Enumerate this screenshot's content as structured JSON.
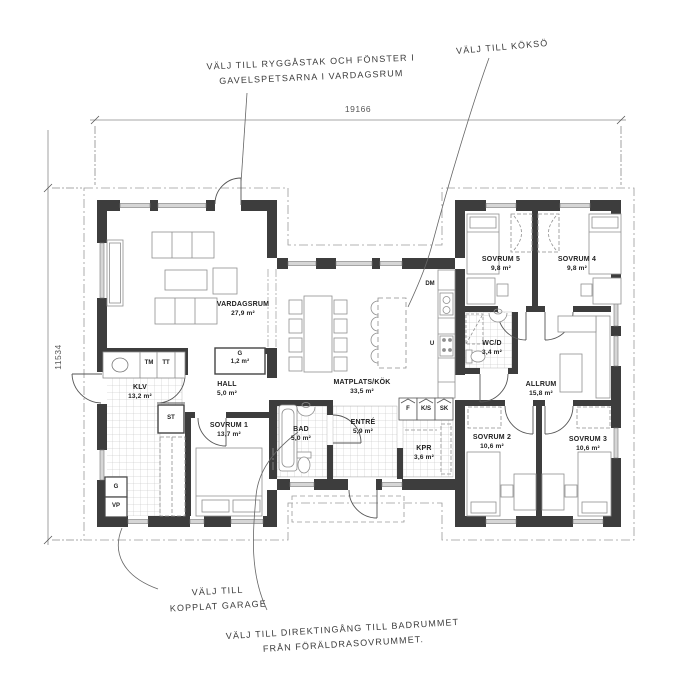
{
  "annotations": {
    "ridge_line1": "VÄLJ TILL RYGGÅSTAK OCH FÖNSTER I",
    "ridge_line2": "GAVELSPETSARNA I VARDAGSRUM",
    "island": "VÄLJ TILL KÖKSÖ",
    "garage_line1": "VÄLJ TILL",
    "garage_line2": "KOPPLAT GARAGE",
    "bath_line1": "VÄLJ TILL DIREKTINGÅNG TILL BADRUMMET",
    "bath_line2": "FRÅN FÖRÄLDRASOVRUMMET."
  },
  "dimensions": {
    "overall_width_mm": "19166",
    "overall_height_mm": "11534"
  },
  "rooms": [
    {
      "name": "VARDAGSRUM",
      "area": "27,9 m²"
    },
    {
      "name": "KLV",
      "area": "13,2 m²"
    },
    {
      "name": "HALL",
      "area": "5,0 m²"
    },
    {
      "name": "SOVRUM 1",
      "area": "13,7 m²"
    },
    {
      "name": "BAD",
      "area": "5,0 m²"
    },
    {
      "name": "ENTRÉ",
      "area": "5,9 m²"
    },
    {
      "name": "MATPLATS/KÖK",
      "area": "33,5 m²"
    },
    {
      "name": "KPR",
      "area": "3,6 m²"
    },
    {
      "name": "SOVRUM 5",
      "area": "9,8 m²"
    },
    {
      "name": "SOVRUM 4",
      "area": "9,8 m²"
    },
    {
      "name": "WC/D",
      "area": "3,4 m²"
    },
    {
      "name": "ALLRUM",
      "area": "15,8 m²"
    },
    {
      "name": "SOVRUM 2",
      "area": "10,6 m²"
    },
    {
      "name": "SOVRUM 3",
      "area": "10,6 m²"
    },
    {
      "name": "G",
      "area": "1,2 m²"
    }
  ],
  "fixtures": {
    "tm": "TM",
    "tt": "TT",
    "st": "ST",
    "g": "G",
    "vp": "VP",
    "dm": "DM",
    "u": "U",
    "f": "F",
    "ks": "K/S",
    "sk": "SK"
  },
  "colors": {
    "wall": "#3d3d3d",
    "line": "#8f8f8f",
    "dashdot": "#9a9a9a",
    "sill": "#d6d6d6",
    "text": "#1e1e1e"
  }
}
